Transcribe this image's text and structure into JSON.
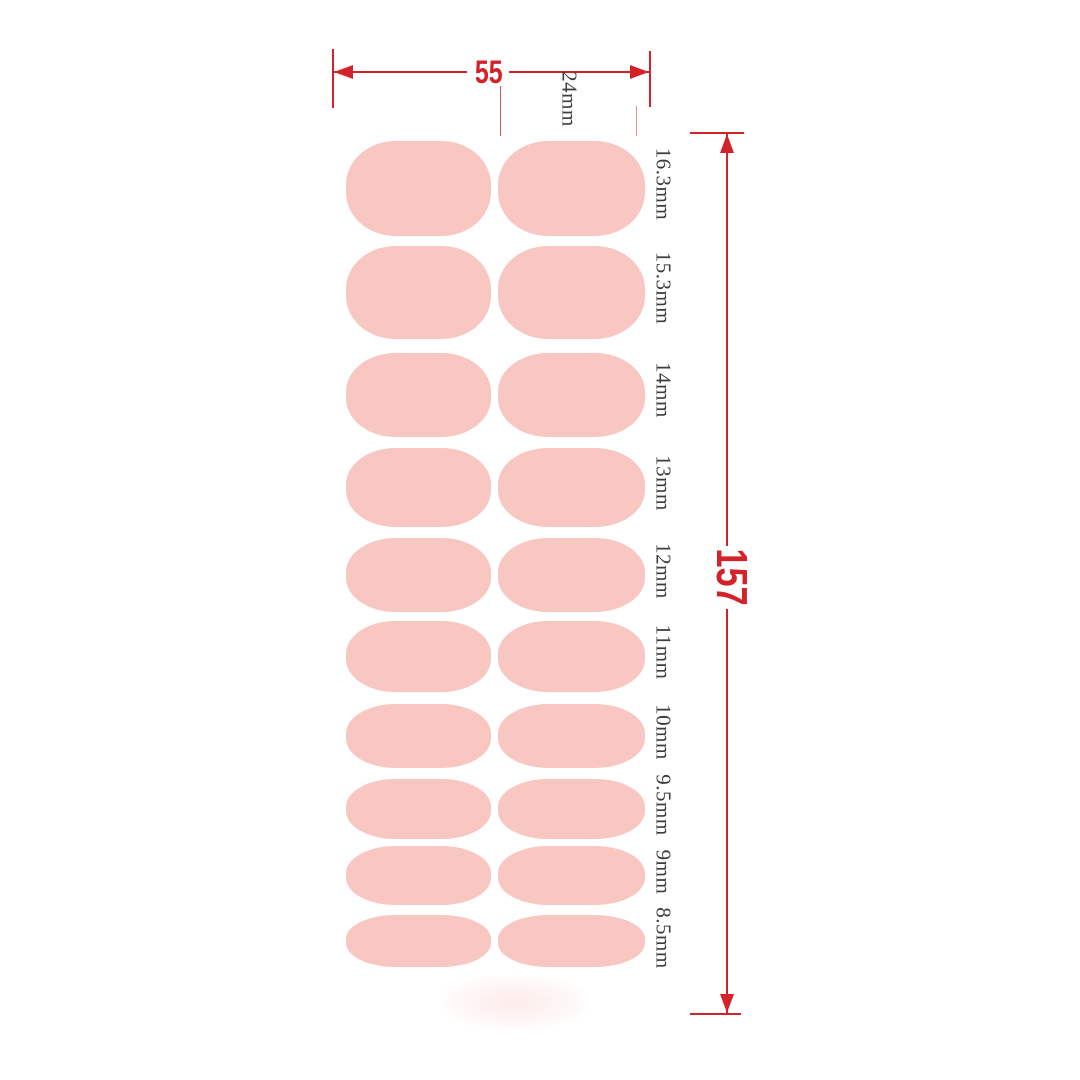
{
  "diagram": {
    "title_semantic": "nail-sticker-size-chart",
    "colors": {
      "dimension_red": "#d2232b",
      "nail_pink": "#f8c7c2",
      "label_ink": "#3d3d3d",
      "background": "#ffffff"
    },
    "width_dimension": {
      "label": "55"
    },
    "inner_width_dimension": {
      "label": "24mm"
    },
    "height_dimension": {
      "label": "157"
    },
    "rows": [
      {
        "label": "16.3mm"
      },
      {
        "label": "15.3mm"
      },
      {
        "label": "14mm"
      },
      {
        "label": "13mm"
      },
      {
        "label": "12mm"
      },
      {
        "label": "11mm"
      },
      {
        "label": "10mm"
      },
      {
        "label": "9.5mm"
      },
      {
        "label": "9mm"
      },
      {
        "label": "8.5mm"
      }
    ]
  }
}
